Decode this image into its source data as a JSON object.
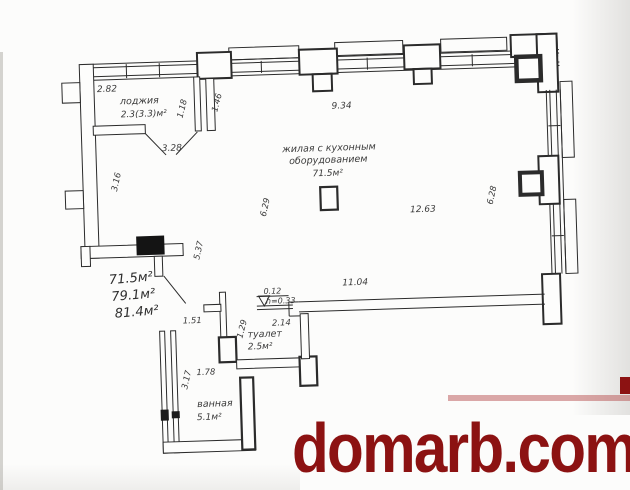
{
  "watermark": {
    "text": "domarb.com",
    "color": "#8c1212"
  },
  "rooms": {
    "loggia": {
      "label": "лоджия",
      "area": "2.3(3.3)м²"
    },
    "living": {
      "label_line1": "жилая с кухонным",
      "label_line2": "оборудованием",
      "area": "71.5м²"
    },
    "toilet": {
      "label": "туалет",
      "area": "2.5м²"
    },
    "bathroom": {
      "label": "ванная",
      "area": "5.1м²"
    }
  },
  "area_summary": {
    "line1": "71.5м²",
    "line2": "79.1м²",
    "line3": "81.4м²"
  },
  "dimensions": {
    "loggia_width": "2.82",
    "loggia_pier_a": "1.18",
    "loggia_pier_b": "1.46",
    "loggia_opening": "3.28",
    "living_top_width": "9.34",
    "left_upper_depth": "3.16",
    "living_left_depth": "6.29",
    "living_width": "12.63",
    "living_right_depth": "6.28",
    "lower_left_depth": "5.37",
    "living_bottom_width": "11.04",
    "step_width": "0.12",
    "step_height": "h=0.33",
    "hall_opening": "1.51",
    "toilet_width": "1.29",
    "toilet_depth": "2.14",
    "bathroom_width": "1.78",
    "bathroom_depth": "3.17"
  },
  "colors": {
    "ink": "#2b2b2b",
    "paper": "#fcfcfb",
    "watermark_red": "#8c1212"
  }
}
